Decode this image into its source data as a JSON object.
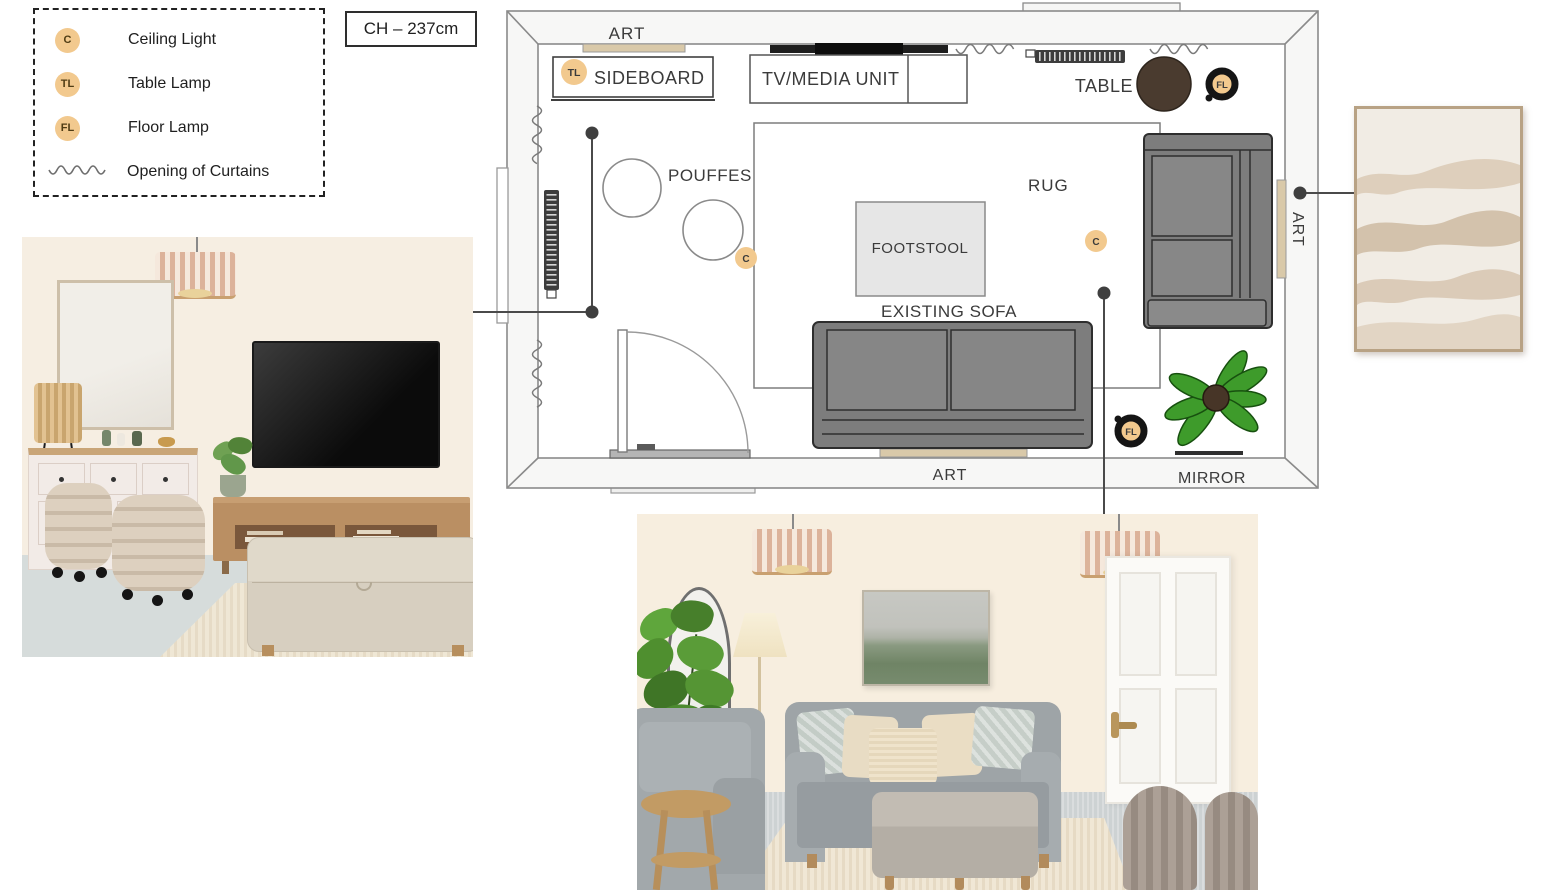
{
  "legend": {
    "items": [
      {
        "symbol": "C",
        "label": "Ceiling Light"
      },
      {
        "symbol": "TL",
        "label": "Table Lamp"
      },
      {
        "symbol": "FL",
        "label": "Floor Lamp"
      },
      {
        "symbol": "wavy-line",
        "label": "Opening of Curtains"
      }
    ]
  },
  "ceiling_height": {
    "label": "CH – 237cm"
  },
  "floor_plan": {
    "labels": {
      "art_top": "ART",
      "sideboard": "SIDEBOARD",
      "tv_media_unit": "TV/MEDIA UNIT",
      "table": "TABLE",
      "pouffes": "POUFFES",
      "rug": "RUG",
      "footstool": "FOOTSTOOL",
      "existing_sofa": "EXISTING SOFA",
      "art_bottom": "ART",
      "mirror": "MIRROR",
      "art_right_wall": "ART"
    },
    "markers": {
      "table_lamp": "TL",
      "floor_lamp_by_table": "FL",
      "floor_lamp_by_plant": "FL",
      "ceiling_light_left": "C",
      "ceiling_light_right": "C"
    },
    "colors": {
      "lamp_marker_fill": "#F2C98E",
      "floor_lamp_ring": "#151515",
      "sofa_gray": "#7D7D7D",
      "footstool_gray": "#E6E6E6",
      "art_bar_tan": "#D9C9A9",
      "table_brown": "#4A3B2F",
      "plant_green": "#3E9B2B",
      "wall_line_gray": "#8A8A8A"
    }
  }
}
